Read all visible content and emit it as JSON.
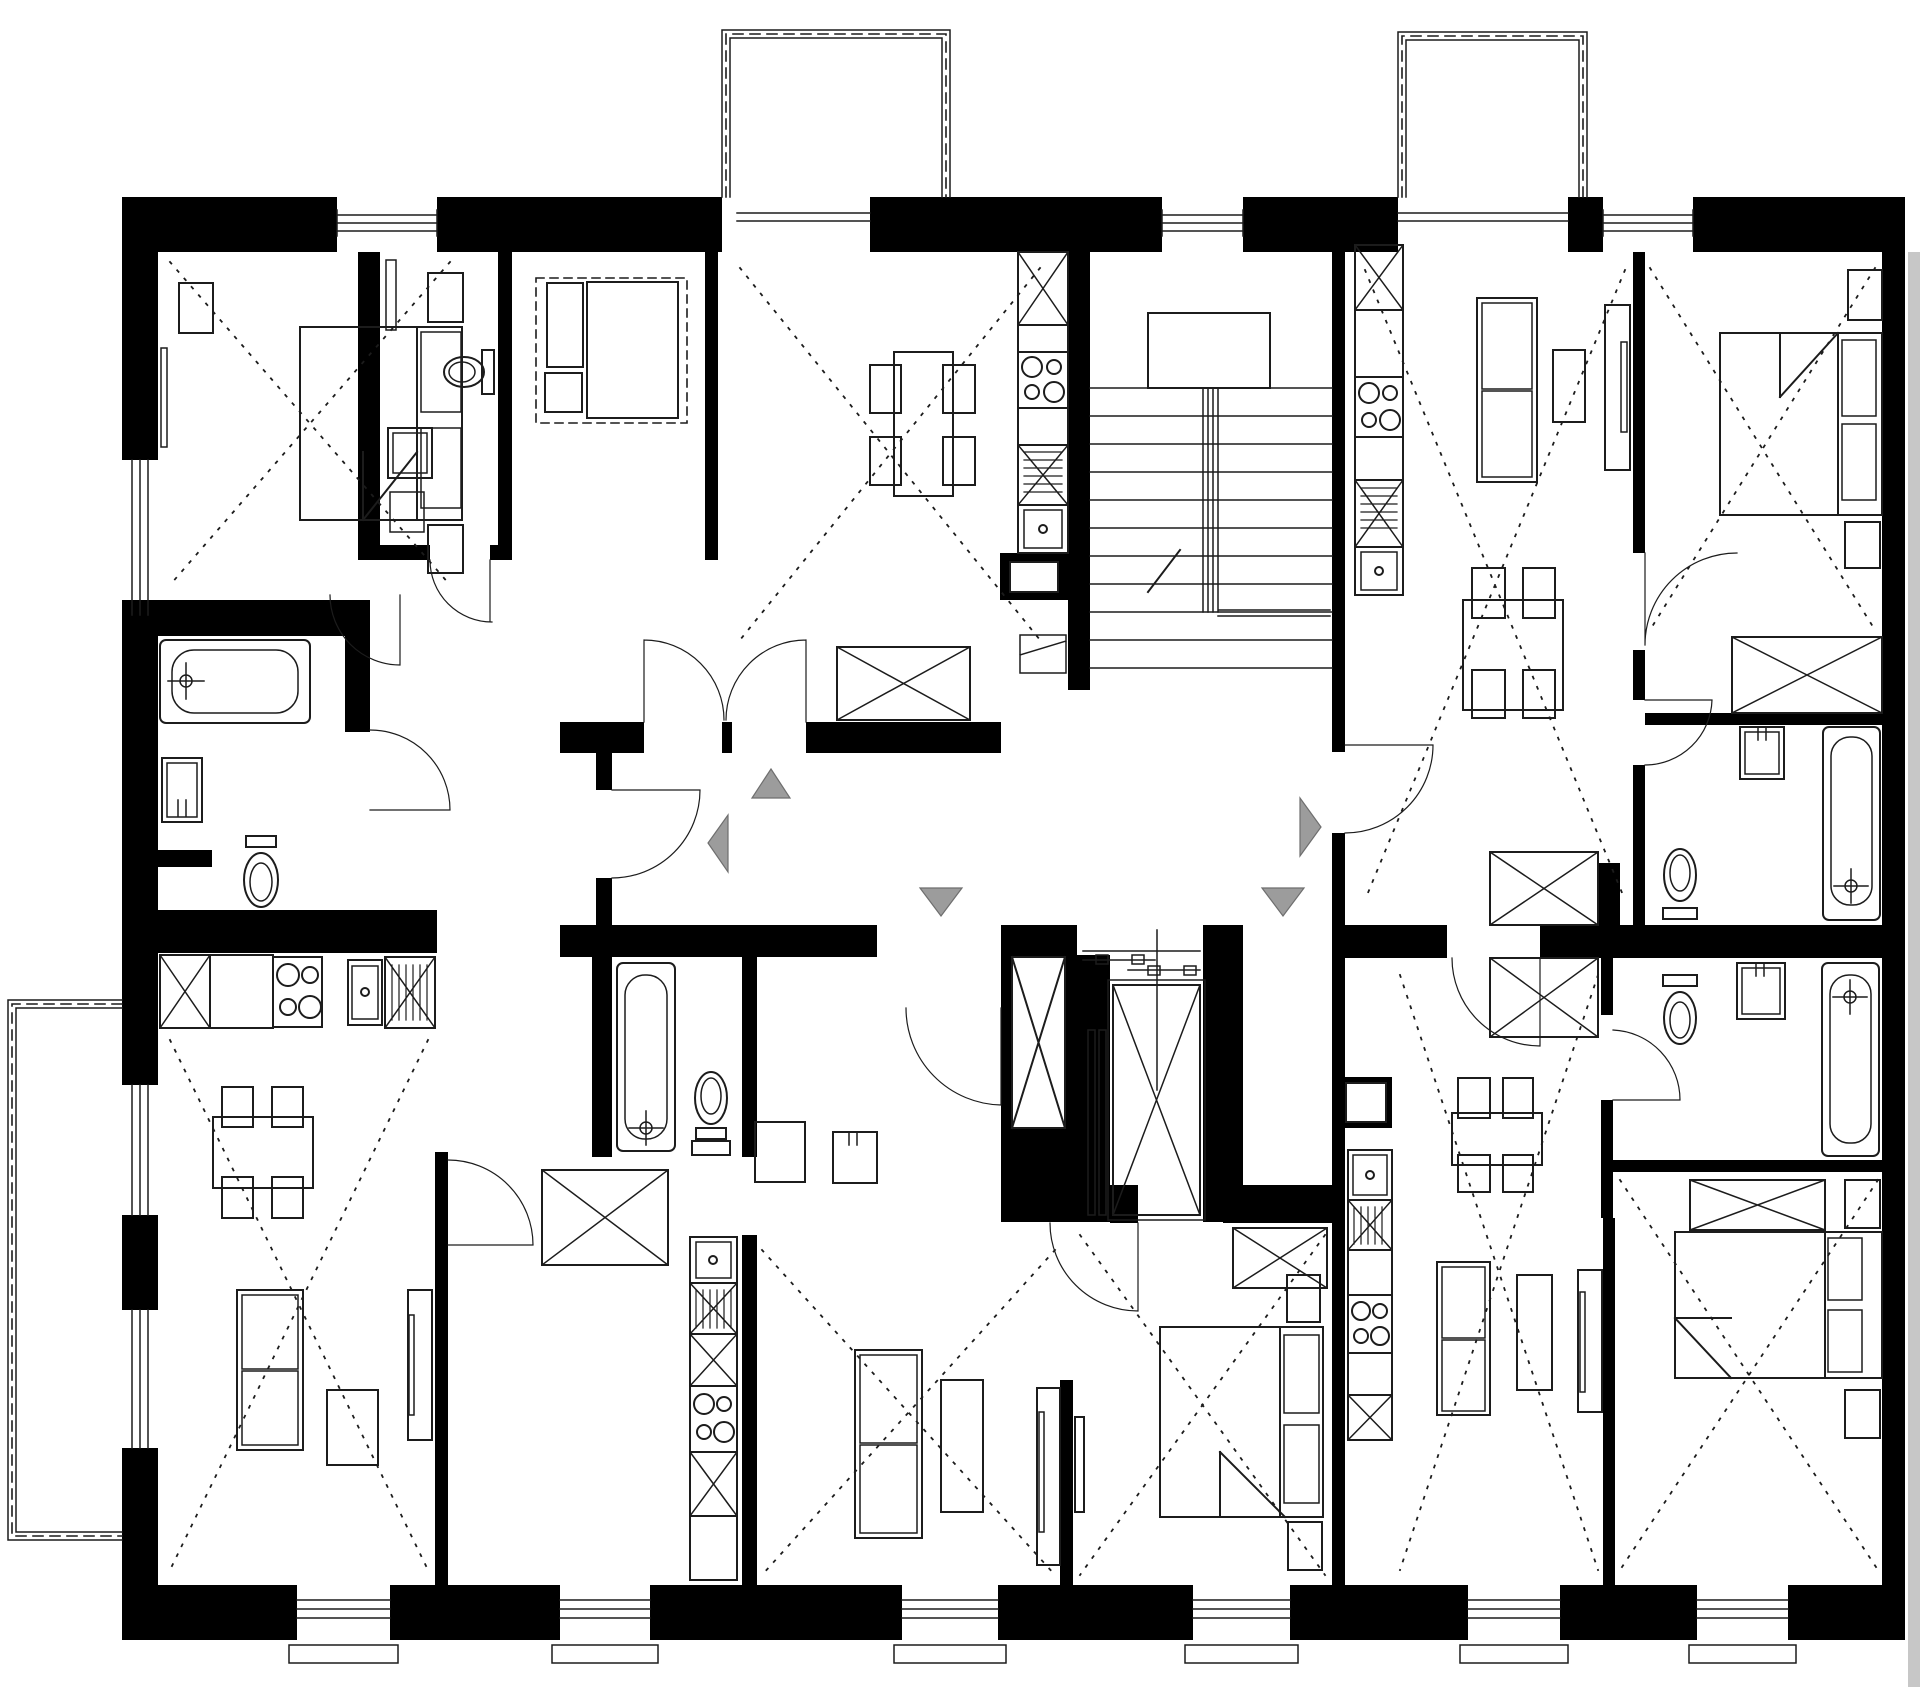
{
  "title": "Apartment building floor plan (no text labels in drawing)",
  "plan": {
    "type": "architectural-floor-plan",
    "orientation": "multi-unit residential storey with central stair and elevator core",
    "units": [
      {
        "position": "upper-left",
        "rooms": [
          "bedroom with double bed",
          "wc with toilet and basin",
          "living room with rug, sofa and side table",
          "inner hall"
        ]
      },
      {
        "position": "upper-middle",
        "rooms": [
          "living-dining room with table for four",
          "single-row kitchen along stair wall",
          "hall with built-in wardrobe",
          "access to top balcony"
        ]
      },
      {
        "position": "upper-right",
        "rooms": [
          "living room with sofa, coffee table and tv board",
          "dining table for four",
          "bedroom with double bed and wardrobe",
          "bathroom with bathtub, basin and toilet",
          "access to top balcony"
        ]
      },
      {
        "position": "lower-left",
        "rooms": [
          "living room with dining table, sofa, coffee table and tv board",
          "kitchen row with stove, sink and dishwasher",
          "bathroom with bathtub, washing machine and toilet",
          "access to side balcony"
        ]
      },
      {
        "position": "lower-middle",
        "rooms": [
          "living room with sofa, coffee table and tv wall",
          "bathroom with bathtub, toilet and basin",
          "vertical kitchen row",
          "bedroom with double bed and wardrobe",
          "hall with built-in wardrobe"
        ]
      },
      {
        "position": "lower-right",
        "rooms": [
          "living room with sofa, coffee table and tv board",
          "dining table for four",
          "vertical kitchen row",
          "bedroom with double bed and wardrobe",
          "bathroom with bathtub, basin and toilet"
        ]
      }
    ],
    "circulation": {
      "staircase": {
        "flights": 1,
        "treads_drawn": 11,
        "landing": true,
        "center_handrail": true,
        "direction_tick": true
      },
      "elevator": {
        "car_symbol": "rectangle with X",
        "sliding_door": true,
        "guide_rails": 2,
        "lobby": true
      },
      "corridor": "central entrance corridor connecting all unit doors"
    },
    "entry_arrows": [
      {
        "direction": "up",
        "x": 771,
        "y": 785
      },
      {
        "direction": "left",
        "x": 717,
        "y": 843
      },
      {
        "direction": "down",
        "x": 941,
        "y": 900
      },
      {
        "direction": "down",
        "x": 1283,
        "y": 900
      },
      {
        "direction": "right",
        "x": 1311,
        "y": 827
      }
    ],
    "balconies": [
      {
        "position": "top-left-of-center",
        "railing": "double line with dashed inner line"
      },
      {
        "position": "top-right-of-center",
        "railing": "double line with dashed inner line"
      },
      {
        "position": "left-side",
        "railing": "double line with dashed inner line"
      }
    ],
    "fixture_counts": {
      "double_beds": 4,
      "sofas": 5,
      "coffee_tables": 5,
      "tv_boards": 5,
      "dining_tables_with_4_chairs": 4,
      "kitchen_rows": 5,
      "four_burner_stoves": 5,
      "kitchen_sinks": 5,
      "dishwashers_hatched": 5,
      "bathtubs": 4,
      "toilets": 5,
      "wash_basins": 5,
      "washing_machines": 1,
      "built_in_wardrobes_x_symbol": 10,
      "windows_bottom": 6,
      "windows_top": 3,
      "windows_left": 3,
      "door_swings": 13
    }
  },
  "colors": {
    "bg": "#ffffff",
    "wall": "#000000",
    "line": "#1c1c1c",
    "thin": "#2a2a2a",
    "arrow": "#9c9c9c",
    "arrowEdge": "#6e6e6e",
    "neighbor": "#c7c7c7",
    "white": "#ffffff"
  }
}
